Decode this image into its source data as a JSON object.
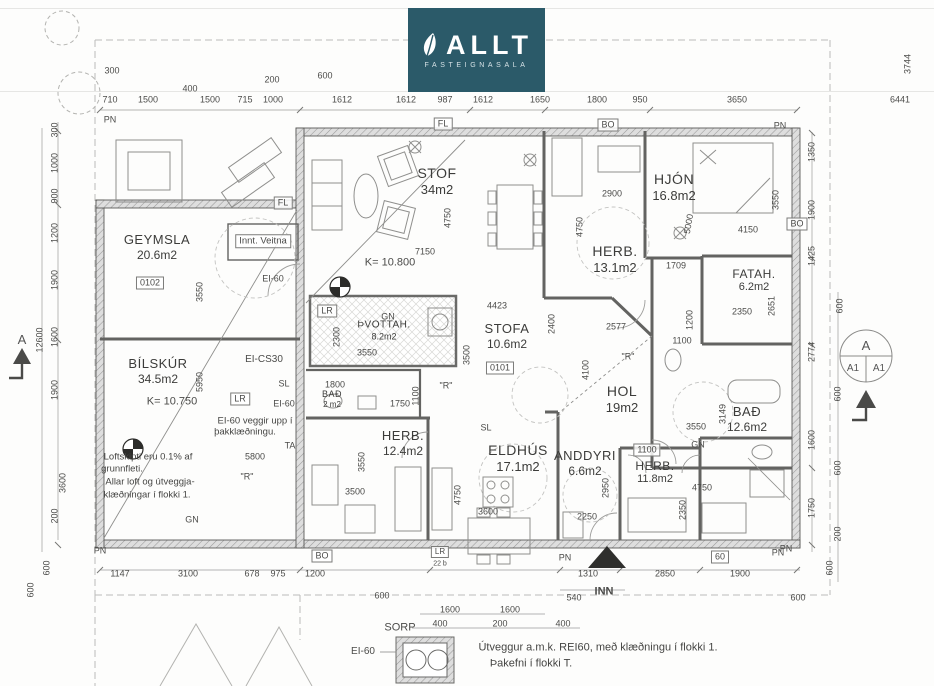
{
  "logo": {
    "brand": "ALLT",
    "subtitle": "FASTEIGNASALA",
    "bg_color": "#2b5a69",
    "leaf_icon": "leaf-icon"
  },
  "section_markers": {
    "left_letter": "A",
    "right_top": "A",
    "right_left": "A1",
    "right_right": "A1"
  },
  "plan": {
    "rooms": [
      {
        "name": "GEYMSLA",
        "area": "20.6m2",
        "x": 157,
        "y": 247,
        "s": 13
      },
      {
        "name": "BÍLSKÚR",
        "area": "34.5m2",
        "x": 158,
        "y": 371,
        "s": 13
      },
      {
        "name": "STOF",
        "area": "34m2",
        "x": 437,
        "y": 181,
        "s": 14
      },
      {
        "name": "HJÓN",
        "area": "16.8m2",
        "x": 674,
        "y": 187,
        "s": 14
      },
      {
        "name": "HERB.",
        "area": "13.1m2",
        "x": 615,
        "y": 259,
        "s": 14
      },
      {
        "name": "FATAH.",
        "area": "6.2m2",
        "x": 754,
        "y": 281,
        "s": 12
      },
      {
        "name": "ÞVOTTAH.",
        "area": "8.2m2",
        "x": 384,
        "y": 331,
        "s": 10
      },
      {
        "name": "STOFA",
        "area": "10.6m2",
        "x": 507,
        "y": 336,
        "s": 13
      },
      {
        "name": "BAÐ",
        "area": "2 m2",
        "x": 332,
        "y": 399,
        "s": 9
      },
      {
        "name": "HOL",
        "area": "19m2",
        "x": 622,
        "y": 399,
        "s": 14
      },
      {
        "name": "BAÐ",
        "area": "12.6m2",
        "x": 747,
        "y": 419,
        "s": 13
      },
      {
        "name": "HERB.",
        "area": "12.4m2",
        "x": 403,
        "y": 443,
        "s": 13
      },
      {
        "name": "ELDHÚS",
        "area": "17.1m2",
        "x": 518,
        "y": 458,
        "s": 14
      },
      {
        "name": "ANDDYRI",
        "area": "6.6m2",
        "x": 585,
        "y": 463,
        "s": 13
      },
      {
        "name": "HERB.",
        "area": "11.8m2",
        "x": 655,
        "y": 473,
        "s": 12
      }
    ],
    "annotations": [
      {
        "t": "300",
        "x": 112,
        "y": 71
      },
      {
        "t": "400",
        "x": 190,
        "y": 89
      },
      {
        "t": "200",
        "x": 272,
        "y": 80
      },
      {
        "t": "600",
        "x": 325,
        "y": 76
      },
      {
        "t": "710",
        "x": 110,
        "y": 100
      },
      {
        "t": "1500",
        "x": 148,
        "y": 100
      },
      {
        "t": "1500",
        "x": 210,
        "y": 100
      },
      {
        "t": "715",
        "x": 245,
        "y": 100
      },
      {
        "t": "1000",
        "x": 273,
        "y": 100
      },
      {
        "t": "1612",
        "x": 342,
        "y": 100
      },
      {
        "t": "1612",
        "x": 406,
        "y": 100
      },
      {
        "t": "987",
        "x": 445,
        "y": 100
      },
      {
        "t": "1612",
        "x": 483,
        "y": 100
      },
      {
        "t": "1650",
        "x": 540,
        "y": 100
      },
      {
        "t": "1800",
        "x": 597,
        "y": 100
      },
      {
        "t": "950",
        "x": 640,
        "y": 100
      },
      {
        "t": "3650",
        "x": 737,
        "y": 100
      },
      {
        "t": "6441",
        "x": 900,
        "y": 100
      },
      {
        "t": "3744",
        "x": 908,
        "y": 64,
        "r": -90
      },
      {
        "t": "PN",
        "x": 110,
        "y": 120,
        "k": "tag"
      },
      {
        "t": "FL",
        "x": 443,
        "y": 124,
        "b": 1,
        "k": "tag"
      },
      {
        "t": "BO",
        "x": 608,
        "y": 125,
        "b": 1,
        "k": "tag"
      },
      {
        "t": "PN",
        "x": 780,
        "y": 126,
        "k": "tag"
      },
      {
        "t": "FL",
        "x": 283,
        "y": 203,
        "b": 1,
        "k": "tag"
      },
      {
        "t": "300",
        "x": 55,
        "y": 130,
        "r": -90
      },
      {
        "t": "1000",
        "x": 55,
        "y": 163,
        "r": -90
      },
      {
        "t": "900",
        "x": 55,
        "y": 196,
        "r": -90
      },
      {
        "t": "1200",
        "x": 55,
        "y": 233,
        "r": -90
      },
      {
        "t": "1900",
        "x": 55,
        "y": 280,
        "r": -90
      },
      {
        "t": "1600",
        "x": 55,
        "y": 337,
        "r": -90
      },
      {
        "t": "1900",
        "x": 55,
        "y": 390,
        "r": -90
      },
      {
        "t": "3600",
        "x": 63,
        "y": 483,
        "r": -90
      },
      {
        "t": "200",
        "x": 55,
        "y": 516,
        "r": -90
      },
      {
        "t": "12600",
        "x": 40,
        "y": 340,
        "r": -90
      },
      {
        "t": "600",
        "x": 47,
        "y": 568,
        "r": -90
      },
      {
        "t": "600",
        "x": 31,
        "y": 590,
        "r": -90
      },
      {
        "t": "1350",
        "x": 812,
        "y": 152,
        "r": -90
      },
      {
        "t": "1900",
        "x": 812,
        "y": 210,
        "r": -90
      },
      {
        "t": "1425",
        "x": 812,
        "y": 256,
        "r": -90
      },
      {
        "t": "600",
        "x": 840,
        "y": 306,
        "r": -90
      },
      {
        "t": "2774",
        "x": 812,
        "y": 352,
        "r": -90
      },
      {
        "t": "600",
        "x": 838,
        "y": 394,
        "r": -90
      },
      {
        "t": "1600",
        "x": 812,
        "y": 440,
        "r": -90
      },
      {
        "t": "600",
        "x": 838,
        "y": 468,
        "r": -90
      },
      {
        "t": "1750",
        "x": 812,
        "y": 508,
        "r": -90
      },
      {
        "t": "200",
        "x": 838,
        "y": 534,
        "r": -90
      },
      {
        "t": "600",
        "x": 830,
        "y": 568,
        "r": -90
      },
      {
        "t": "BO",
        "x": 797,
        "y": 224,
        "b": 1,
        "k": "tag"
      },
      {
        "t": "PN",
        "x": 786,
        "y": 549,
        "k": "tag"
      },
      {
        "t": "1147",
        "x": 120,
        "y": 574
      },
      {
        "t": "3100",
        "x": 188,
        "y": 574
      },
      {
        "t": "678",
        "x": 252,
        "y": 574
      },
      {
        "t": "975",
        "x": 278,
        "y": 574
      },
      {
        "t": "1200",
        "x": 315,
        "y": 574
      },
      {
        "t": "600",
        "x": 382,
        "y": 596
      },
      {
        "t": "1310",
        "x": 588,
        "y": 574
      },
      {
        "t": "2850",
        "x": 665,
        "y": 574
      },
      {
        "t": "1900",
        "x": 740,
        "y": 574
      },
      {
        "t": "540",
        "x": 574,
        "y": 598
      },
      {
        "t": "INN",
        "x": 604,
        "y": 592,
        "k": "tag",
        "w": 1,
        "s": 11
      },
      {
        "t": "600",
        "x": 798,
        "y": 598
      },
      {
        "t": "BO",
        "x": 322,
        "y": 556,
        "b": 1,
        "k": "tag"
      },
      {
        "t": "60",
        "x": 720,
        "y": 557,
        "b": 1,
        "k": "tag"
      },
      {
        "t": "PN",
        "x": 100,
        "y": 551,
        "k": "tag"
      },
      {
        "t": "PN",
        "x": 565,
        "y": 558,
        "k": "tag"
      },
      {
        "t": "PN",
        "x": 778,
        "y": 553,
        "k": "tag"
      },
      {
        "t": "LR",
        "x": 440,
        "y": 552,
        "b": 1,
        "k": "tag",
        "s": 8
      },
      {
        "t": "22 b",
        "x": 440,
        "y": 564,
        "k": "tag",
        "s": 7
      },
      {
        "t": "1600",
        "x": 450,
        "y": 610
      },
      {
        "t": "1600",
        "x": 510,
        "y": 610
      },
      {
        "t": "400",
        "x": 440,
        "y": 624
      },
      {
        "t": "200",
        "x": 500,
        "y": 624
      },
      {
        "t": "400",
        "x": 563,
        "y": 624
      },
      {
        "t": "SORP",
        "x": 400,
        "y": 628,
        "k": "tag",
        "s": 11
      },
      {
        "t": "EI-60",
        "x": 363,
        "y": 652,
        "k": "tag",
        "s": 10
      },
      {
        "t": "Útveggur a.m.k. REI60, með klæðningu í flokki 1.",
        "x": 598,
        "y": 648,
        "k": "note",
        "s": 11
      },
      {
        "t": "Þakefni í flokki T.",
        "x": 531,
        "y": 664,
        "k": "note",
        "s": 11
      },
      {
        "t": "0102",
        "x": 150,
        "y": 283,
        "b": 1
      },
      {
        "t": "0101",
        "x": 500,
        "y": 368,
        "b": 1
      },
      {
        "t": "Innt. Veitna",
        "x": 263,
        "y": 241,
        "b": 1,
        "k": "room",
        "s": 9.5
      },
      {
        "t": "EI-60",
        "x": 273,
        "y": 279,
        "k": "tag"
      },
      {
        "t": "3550",
        "x": 200,
        "y": 292,
        "r": -90
      },
      {
        "t": "EI-CS30",
        "x": 264,
        "y": 360,
        "k": "tag",
        "s": 10
      },
      {
        "t": "SL",
        "x": 284,
        "y": 384,
        "k": "tag"
      },
      {
        "t": "LR",
        "x": 240,
        "y": 399,
        "b": 1,
        "k": "tag"
      },
      {
        "t": "EI-60",
        "x": 284,
        "y": 404,
        "k": "tag"
      },
      {
        "t": "5950",
        "x": 200,
        "y": 382,
        "r": -90
      },
      {
        "t": "K= 10.750",
        "x": 172,
        "y": 402,
        "k": "tag",
        "s": 11
      },
      {
        "t": "EI-60 veggir upp í",
        "x": 255,
        "y": 421,
        "k": "note",
        "s": 9.5
      },
      {
        "t": "þakklæðningu.",
        "x": 245,
        "y": 432,
        "k": "note",
        "s": 9.5
      },
      {
        "t": "TA",
        "x": 290,
        "y": 446,
        "k": "tag"
      },
      {
        "t": "Loftskipti eru 0.1% af",
        "x": 148,
        "y": 457,
        "k": "note",
        "s": 9.5
      },
      {
        "t": "5800",
        "x": 255,
        "y": 457
      },
      {
        "t": "grunnfleti.",
        "x": 122,
        "y": 469,
        "k": "note",
        "s": 9.5
      },
      {
        "t": "Allar loft og útveggja-",
        "x": 150,
        "y": 482,
        "k": "note",
        "s": 9.5
      },
      {
        "t": "klæðningar í flokki 1.",
        "x": 147,
        "y": 495,
        "k": "note",
        "s": 9.5
      },
      {
        "t": "\"R\"",
        "x": 247,
        "y": 477,
        "k": "tag"
      },
      {
        "t": "GN",
        "x": 192,
        "y": 520,
        "k": "tag"
      },
      {
        "t": "K= 10.800",
        "x": 390,
        "y": 263,
        "k": "tag",
        "s": 11
      },
      {
        "t": "7150",
        "x": 425,
        "y": 252
      },
      {
        "t": "4750",
        "x": 448,
        "y": 218,
        "r": -90
      },
      {
        "t": "LR",
        "x": 327,
        "y": 311,
        "b": 1,
        "k": "tag"
      },
      {
        "t": "GN",
        "x": 388,
        "y": 317,
        "k": "tag"
      },
      {
        "t": "2300",
        "x": 337,
        "y": 337,
        "r": -90
      },
      {
        "t": "3550",
        "x": 367,
        "y": 353
      },
      {
        "t": "4423",
        "x": 497,
        "y": 306
      },
      {
        "t": "3500",
        "x": 467,
        "y": 355,
        "r": -90
      },
      {
        "t": "\"R\"",
        "x": 446,
        "y": 386,
        "k": "tag"
      },
      {
        "t": "1800",
        "x": 335,
        "y": 385
      },
      {
        "t": "1750",
        "x": 400,
        "y": 404
      },
      {
        "t": "1100",
        "x": 416,
        "y": 396,
        "r": -90
      },
      {
        "t": "SL",
        "x": 486,
        "y": 428,
        "k": "tag"
      },
      {
        "t": "2577",
        "x": 616,
        "y": 327
      },
      {
        "t": "2400",
        "x": 552,
        "y": 324,
        "r": -90
      },
      {
        "t": "4100",
        "x": 586,
        "y": 370,
        "r": -90
      },
      {
        "t": "\"R\"",
        "x": 628,
        "y": 357,
        "k": "tag"
      },
      {
        "t": "1100",
        "x": 682,
        "y": 341
      },
      {
        "t": "1200",
        "x": 690,
        "y": 320,
        "r": -90
      },
      {
        "t": "2900",
        "x": 612,
        "y": 194
      },
      {
        "t": "4750",
        "x": 580,
        "y": 227,
        "r": -90
      },
      {
        "t": "5000",
        "x": 689,
        "y": 224,
        "r": -80
      },
      {
        "t": "4150",
        "x": 748,
        "y": 230
      },
      {
        "t": "3550",
        "x": 776,
        "y": 200,
        "r": -90
      },
      {
        "t": "1709",
        "x": 676,
        "y": 266
      },
      {
        "t": "2350",
        "x": 742,
        "y": 312
      },
      {
        "t": "2651",
        "x": 772,
        "y": 306,
        "r": -90
      },
      {
        "t": "3550",
        "x": 696,
        "y": 427
      },
      {
        "t": "3149",
        "x": 723,
        "y": 414,
        "r": -90
      },
      {
        "t": "GN",
        "x": 698,
        "y": 445,
        "k": "tag"
      },
      {
        "t": "3550",
        "x": 362,
        "y": 462,
        "r": -90
      },
      {
        "t": "3500",
        "x": 355,
        "y": 492
      },
      {
        "t": "4750",
        "x": 458,
        "y": 495,
        "r": -90
      },
      {
        "t": "3600",
        "x": 488,
        "y": 512
      },
      {
        "t": "2950",
        "x": 606,
        "y": 488,
        "r": -90
      },
      {
        "t": "2250",
        "x": 587,
        "y": 517
      },
      {
        "t": "1100",
        "x": 647,
        "y": 450,
        "b": 1
      },
      {
        "t": "4750",
        "x": 702,
        "y": 488
      },
      {
        "t": "2350",
        "x": 683,
        "y": 510,
        "r": -90
      }
    ]
  }
}
